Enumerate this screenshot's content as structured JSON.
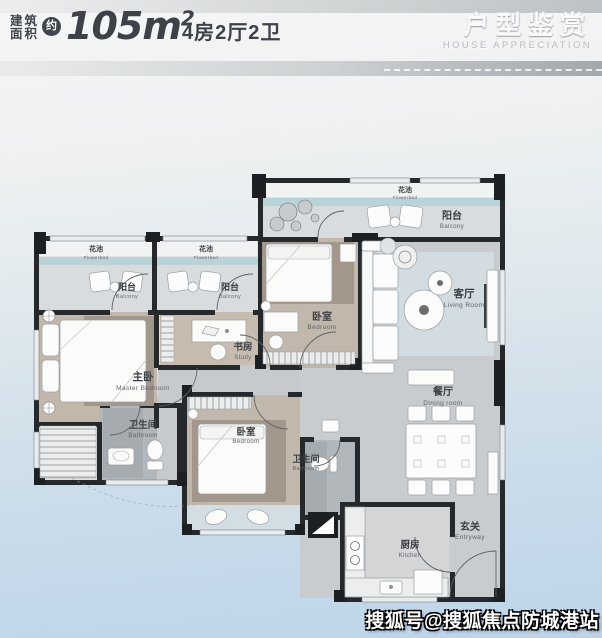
{
  "header": {
    "area_label_line1": "建筑",
    "area_label_line2": "面积",
    "approx": "约",
    "area_value": "105m",
    "area_sup": "2",
    "spec": "4房2厅2卫",
    "title_cn": "户型鉴赏",
    "title_en": "HOUSE APPRECIATION"
  },
  "floorplan": {
    "rooms": {
      "flowerbed": {
        "cn": "花池",
        "en": "Flowerbed"
      },
      "balcony": {
        "cn": "阳台",
        "en": "Balcony"
      },
      "master_bedroom": {
        "cn": "主卧",
        "en": "Master Bedroom"
      },
      "study": {
        "cn": "书房",
        "en": "Study"
      },
      "bedroom": {
        "cn": "卧室",
        "en": "Bedroom"
      },
      "bathroom": {
        "cn": "卫生间",
        "en": "Bathroom"
      },
      "living_room": {
        "cn": "客厅",
        "en": "Living Room"
      },
      "dining_room": {
        "cn": "餐厅",
        "en": "Dining room"
      },
      "kitchen": {
        "cn": "厨房",
        "en": "Kitchen"
      },
      "entryway": {
        "cn": "玄关",
        "en": "Entryway"
      }
    }
  },
  "watermark": {
    "text": "搜狐号@搜狐焦点防城港站"
  },
  "colors": {
    "accent_dark": "#3b4046",
    "flower_strip": "#b9d4d8",
    "bedroom_floor": "#c2b7ab",
    "hall_floor": "#c8cccf",
    "bath_floor": "#b2b7bc",
    "wall": "#26292b",
    "background_bottom": "#c3d8ea"
  }
}
